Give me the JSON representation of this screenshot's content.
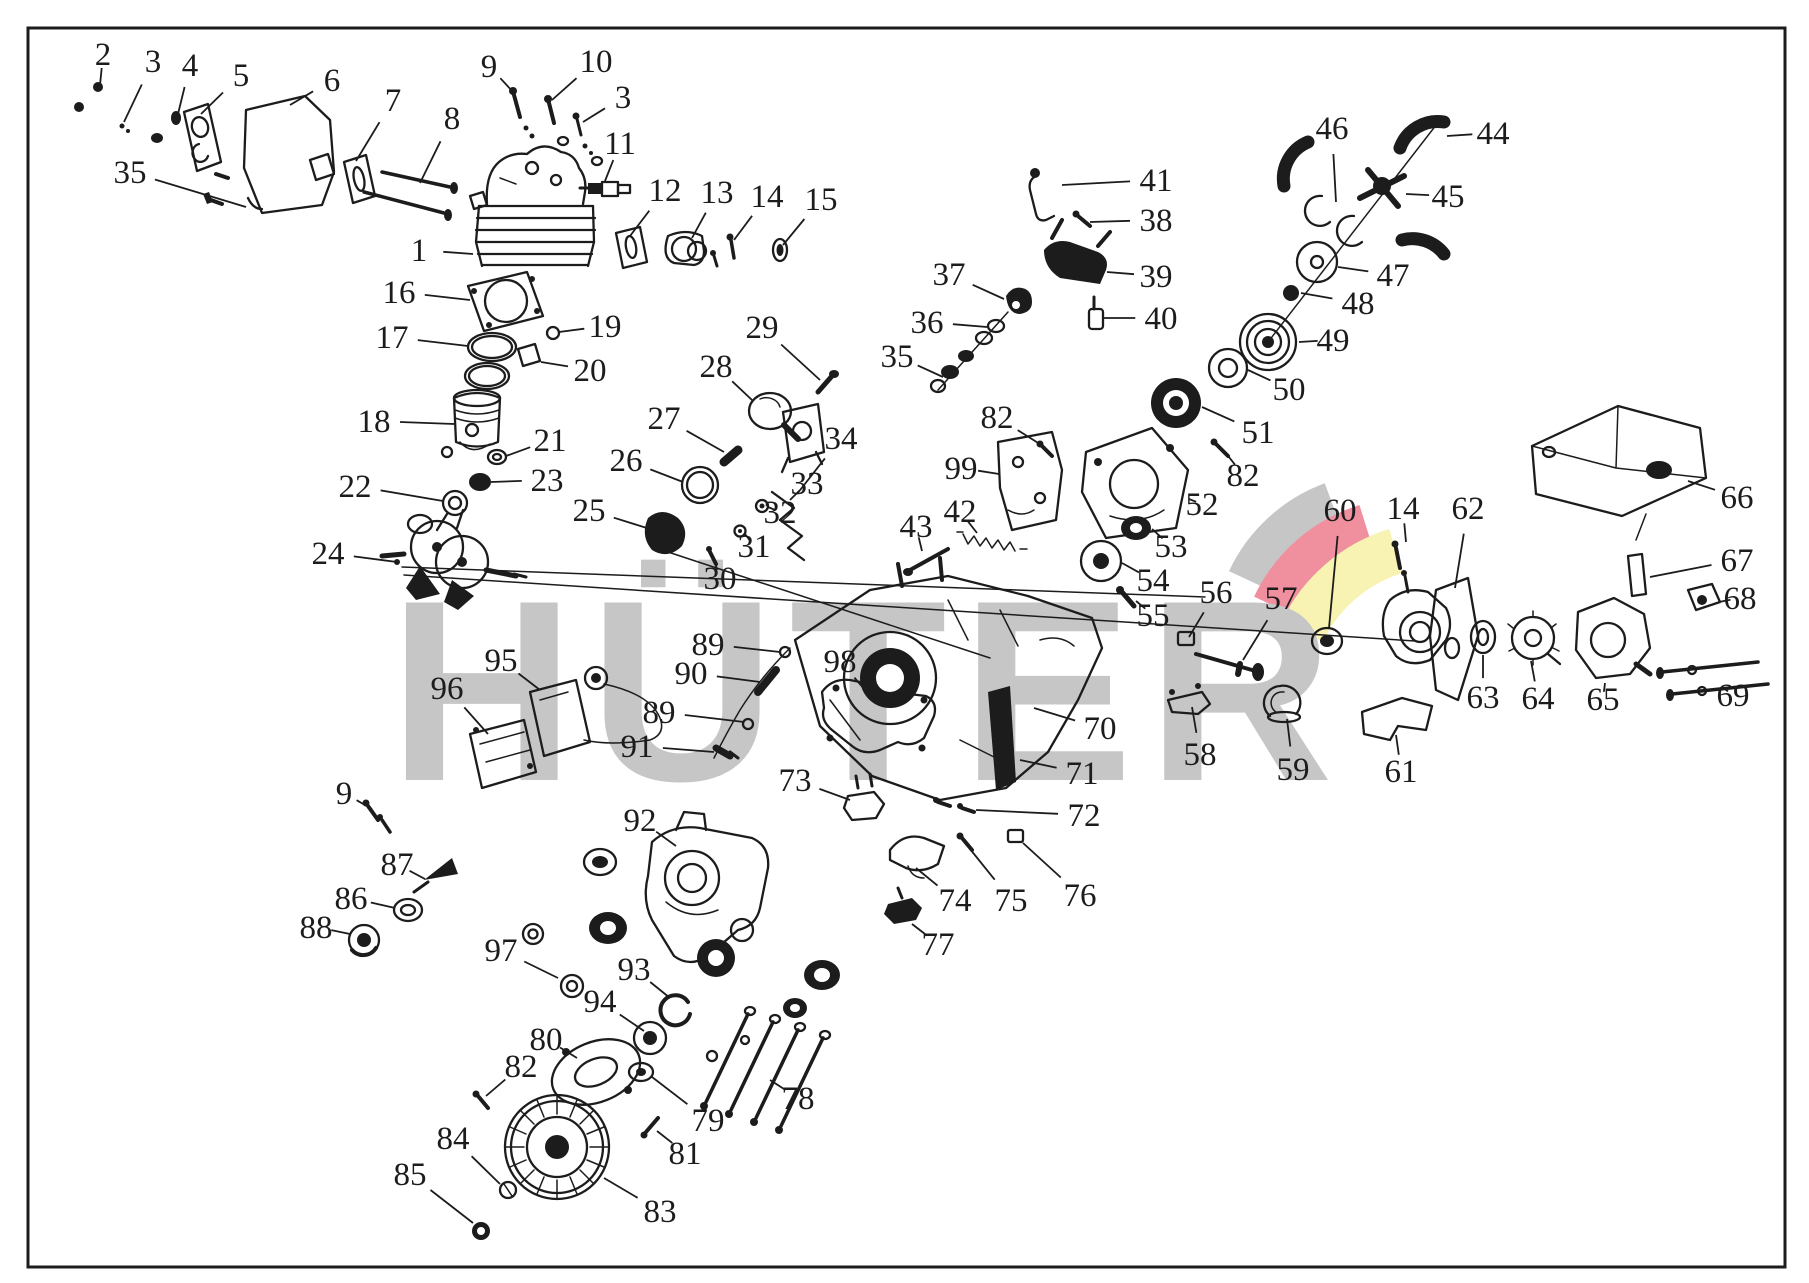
{
  "watermark": {
    "text": "HÜTER",
    "text_color": "#c6c6c6",
    "logo_gray": "#c6c6c6",
    "logo_pink": "#f0909f",
    "logo_yellow": "#f8f3b2"
  },
  "ink_color": "#1c1c1c",
  "callouts": [
    {
      "n": "2",
      "x": 103,
      "y": 54,
      "tx": 100,
      "ty": 85
    },
    {
      "n": "3",
      "x": 153,
      "y": 61,
      "tx": 124,
      "ty": 122
    },
    {
      "n": "4",
      "x": 190,
      "y": 65,
      "tx": 178,
      "ty": 114
    },
    {
      "n": "5",
      "x": 241,
      "y": 75,
      "tx": 201,
      "ty": 114
    },
    {
      "n": "6",
      "x": 332,
      "y": 80,
      "tx": 290,
      "ty": 105
    },
    {
      "n": "7",
      "x": 393,
      "y": 100,
      "tx": 356,
      "ty": 161
    },
    {
      "n": "8",
      "x": 452,
      "y": 118,
      "tx": 420,
      "ty": 183
    },
    {
      "n": "9",
      "x": 489,
      "y": 66,
      "tx": 514,
      "ty": 93
    },
    {
      "n": "10",
      "x": 596,
      "y": 61,
      "tx": 552,
      "ty": 100
    },
    {
      "n": "3",
      "x": 623,
      "y": 97,
      "tx": 583,
      "ty": 122
    },
    {
      "n": "35",
      "x": 130,
      "y": 172,
      "tx": 246,
      "ty": 207
    },
    {
      "n": "11",
      "x": 620,
      "y": 143,
      "tx": 605,
      "ty": 181
    },
    {
      "n": "12",
      "x": 665,
      "y": 190,
      "tx": 630,
      "ty": 236
    },
    {
      "n": "13",
      "x": 717,
      "y": 192,
      "tx": 692,
      "ty": 238
    },
    {
      "n": "14",
      "x": 767,
      "y": 196,
      "tx": 734,
      "ty": 240
    },
    {
      "n": "15",
      "x": 821,
      "y": 199,
      "tx": 783,
      "ty": 245
    },
    {
      "n": "1",
      "x": 419,
      "y": 250,
      "tx": 473,
      "ty": 254
    },
    {
      "n": "16",
      "x": 399,
      "y": 292,
      "tx": 470,
      "ty": 300
    },
    {
      "n": "17",
      "x": 392,
      "y": 337,
      "tx": 468,
      "ty": 346
    },
    {
      "n": "19",
      "x": 605,
      "y": 326,
      "tx": 559,
      "ty": 332
    },
    {
      "n": "20",
      "x": 590,
      "y": 370,
      "tx": 541,
      "ty": 362
    },
    {
      "n": "18",
      "x": 374,
      "y": 421,
      "tx": 454,
      "ty": 424
    },
    {
      "n": "21",
      "x": 550,
      "y": 440,
      "tx": 506,
      "ty": 456
    },
    {
      "n": "23",
      "x": 547,
      "y": 480,
      "tx": 491,
      "ty": 482
    },
    {
      "n": "22",
      "x": 355,
      "y": 486,
      "tx": 443,
      "ty": 501
    },
    {
      "n": "24",
      "x": 328,
      "y": 553,
      "tx": 397,
      "ty": 562
    },
    {
      "n": "25",
      "x": 589,
      "y": 510,
      "tx": 650,
      "ty": 529
    },
    {
      "n": "26",
      "x": 626,
      "y": 460,
      "tx": 683,
      "ty": 482
    },
    {
      "n": "27",
      "x": 664,
      "y": 418,
      "tx": 724,
      "ty": 452
    },
    {
      "n": "28",
      "x": 716,
      "y": 366,
      "tx": 752,
      "ty": 400
    },
    {
      "n": "29",
      "x": 762,
      "y": 327,
      "tx": 820,
      "ty": 380
    },
    {
      "n": "34",
      "x": 841,
      "y": 438,
      "tx": 797,
      "ty": 494
    },
    {
      "n": "33",
      "x": 807,
      "y": 483,
      "tx": 790,
      "ty": 500
    },
    {
      "n": "32",
      "x": 780,
      "y": 512,
      "tx": 768,
      "ty": 507
    },
    {
      "n": "31",
      "x": 754,
      "y": 546,
      "tx": 745,
      "ty": 534
    },
    {
      "n": "30",
      "x": 720,
      "y": 578,
      "tx": 714,
      "ty": 560
    },
    {
      "n": "35",
      "x": 897,
      "y": 356,
      "tx": 943,
      "ty": 377
    },
    {
      "n": "36",
      "x": 927,
      "y": 322,
      "tx": 987,
      "ty": 327
    },
    {
      "n": "37",
      "x": 949,
      "y": 274,
      "tx": 1004,
      "ty": 299
    },
    {
      "n": "38",
      "x": 1156,
      "y": 220,
      "tx": 1090,
      "ty": 222
    },
    {
      "n": "39",
      "x": 1156,
      "y": 276,
      "tx": 1107,
      "ty": 272
    },
    {
      "n": "40",
      "x": 1161,
      "y": 318,
      "tx": 1104,
      "ty": 318
    },
    {
      "n": "41",
      "x": 1156,
      "y": 180,
      "tx": 1062,
      "ty": 185
    },
    {
      "n": "42",
      "x": 960,
      "y": 511,
      "tx": 977,
      "ty": 533
    },
    {
      "n": "43",
      "x": 916,
      "y": 526,
      "tx": 922,
      "ty": 551
    },
    {
      "n": "99",
      "x": 961,
      "y": 468,
      "tx": 999,
      "ty": 474
    },
    {
      "n": "82",
      "x": 997,
      "y": 417,
      "tx": 1043,
      "ty": 446
    },
    {
      "n": "44",
      "x": 1493,
      "y": 133,
      "tx": 1447,
      "ty": 136
    },
    {
      "n": "45",
      "x": 1448,
      "y": 196,
      "tx": 1406,
      "ty": 194
    },
    {
      "n": "46",
      "x": 1332,
      "y": 128,
      "tx": 1336,
      "ty": 202
    },
    {
      "n": "47",
      "x": 1393,
      "y": 275,
      "tx": 1338,
      "ty": 267
    },
    {
      "n": "48",
      "x": 1358,
      "y": 303,
      "tx": 1301,
      "ty": 293
    },
    {
      "n": "49",
      "x": 1333,
      "y": 340,
      "tx": 1299,
      "ty": 342
    },
    {
      "n": "50",
      "x": 1289,
      "y": 389,
      "tx": 1248,
      "ty": 370
    },
    {
      "n": "51",
      "x": 1258,
      "y": 432,
      "tx": 1202,
      "ty": 407
    },
    {
      "n": "82",
      "x": 1243,
      "y": 475,
      "tx": 1225,
      "ty": 452
    },
    {
      "n": "52",
      "x": 1202,
      "y": 504,
      "tx": 1189,
      "ty": 499
    },
    {
      "n": "53",
      "x": 1171,
      "y": 546,
      "tx": 1152,
      "ty": 529
    },
    {
      "n": "54",
      "x": 1153,
      "y": 580,
      "tx": 1122,
      "ty": 563
    },
    {
      "n": "55",
      "x": 1153,
      "y": 615,
      "tx": 1136,
      "ty": 601
    },
    {
      "n": "56",
      "x": 1216,
      "y": 592,
      "tx": 1189,
      "ty": 637
    },
    {
      "n": "57",
      "x": 1281,
      "y": 598,
      "tx": 1243,
      "ty": 660
    },
    {
      "n": "60",
      "x": 1340,
      "y": 510,
      "tx": 1329,
      "ty": 628
    },
    {
      "n": "14",
      "x": 1403,
      "y": 508,
      "tx": 1406,
      "ty": 542
    },
    {
      "n": "62",
      "x": 1468,
      "y": 508,
      "tx": 1455,
      "ty": 588
    },
    {
      "n": "66",
      "x": 1737,
      "y": 497,
      "tx": 1688,
      "ty": 481
    },
    {
      "n": "67",
      "x": 1737,
      "y": 560,
      "tx": 1650,
      "ty": 577
    },
    {
      "n": "68",
      "x": 1740,
      "y": 598,
      "tx": 1719,
      "ty": 602
    },
    {
      "n": "69",
      "x": 1733,
      "y": 695,
      "tx": 1722,
      "ty": 687
    },
    {
      "n": "63",
      "x": 1483,
      "y": 697,
      "tx": 1483,
      "ty": 655
    },
    {
      "n": "64",
      "x": 1538,
      "y": 698,
      "tx": 1531,
      "ty": 661
    },
    {
      "n": "65",
      "x": 1603,
      "y": 699,
      "tx": 1605,
      "ty": 683
    },
    {
      "n": "61",
      "x": 1401,
      "y": 771,
      "tx": 1396,
      "ty": 735
    },
    {
      "n": "59",
      "x": 1293,
      "y": 769,
      "tx": 1287,
      "ty": 719
    },
    {
      "n": "58",
      "x": 1200,
      "y": 754,
      "tx": 1192,
      "ty": 707
    },
    {
      "n": "70",
      "x": 1100,
      "y": 728,
      "tx": 1034,
      "ty": 708
    },
    {
      "n": "71",
      "x": 1082,
      "y": 773,
      "tx": 1020,
      "ty": 760
    },
    {
      "n": "72",
      "x": 1084,
      "y": 815,
      "tx": 976,
      "ty": 810
    },
    {
      "n": "73",
      "x": 795,
      "y": 780,
      "tx": 850,
      "ty": 800
    },
    {
      "n": "89",
      "x": 708,
      "y": 644,
      "tx": 780,
      "ty": 652
    },
    {
      "n": "90",
      "x": 691,
      "y": 673,
      "tx": 760,
      "ty": 682
    },
    {
      "n": "89",
      "x": 659,
      "y": 712,
      "tx": 744,
      "ty": 722
    },
    {
      "n": "91",
      "x": 637,
      "y": 746,
      "tx": 714,
      "ty": 752
    },
    {
      "n": "98",
      "x": 840,
      "y": 661,
      "tx": 872,
      "ty": 698
    },
    {
      "n": "95",
      "x": 501,
      "y": 660,
      "tx": 540,
      "ty": 690
    },
    {
      "n": "96",
      "x": 447,
      "y": 688,
      "tx": 488,
      "ty": 734
    },
    {
      "n": "9",
      "x": 344,
      "y": 793,
      "tx": 372,
      "ty": 809
    },
    {
      "n": "87",
      "x": 397,
      "y": 864,
      "tx": 425,
      "ty": 879
    },
    {
      "n": "86",
      "x": 351,
      "y": 898,
      "tx": 395,
      "ty": 908
    },
    {
      "n": "88",
      "x": 316,
      "y": 927,
      "tx": 350,
      "ty": 934
    },
    {
      "n": "92",
      "x": 640,
      "y": 820,
      "tx": 676,
      "ty": 846
    },
    {
      "n": "97",
      "x": 501,
      "y": 950,
      "tx": 558,
      "ty": 978
    },
    {
      "n": "93",
      "x": 634,
      "y": 969,
      "tx": 670,
      "ty": 998
    },
    {
      "n": "94",
      "x": 600,
      "y": 1001,
      "tx": 644,
      "ty": 1031
    },
    {
      "n": "74",
      "x": 955,
      "y": 900,
      "tx": 916,
      "ty": 868
    },
    {
      "n": "75",
      "x": 1011,
      "y": 900,
      "tx": 970,
      "ty": 849
    },
    {
      "n": "76",
      "x": 1080,
      "y": 895,
      "tx": 1023,
      "ty": 843
    },
    {
      "n": "77",
      "x": 938,
      "y": 944,
      "tx": 912,
      "ty": 924
    },
    {
      "n": "80",
      "x": 546,
      "y": 1039,
      "tx": 577,
      "ty": 1058
    },
    {
      "n": "82",
      "x": 521,
      "y": 1066,
      "tx": 486,
      "ty": 1096
    },
    {
      "n": "78",
      "x": 798,
      "y": 1098,
      "tx": 770,
      "ty": 1080
    },
    {
      "n": "79",
      "x": 708,
      "y": 1120,
      "tx": 652,
      "ty": 1077
    },
    {
      "n": "81",
      "x": 685,
      "y": 1153,
      "tx": 657,
      "ty": 1131
    },
    {
      "n": "84",
      "x": 453,
      "y": 1138,
      "tx": 500,
      "ty": 1184
    },
    {
      "n": "85",
      "x": 410,
      "y": 1174,
      "tx": 473,
      "ty": 1223
    },
    {
      "n": "83",
      "x": 660,
      "y": 1211,
      "tx": 604,
      "ty": 1178
    }
  ]
}
